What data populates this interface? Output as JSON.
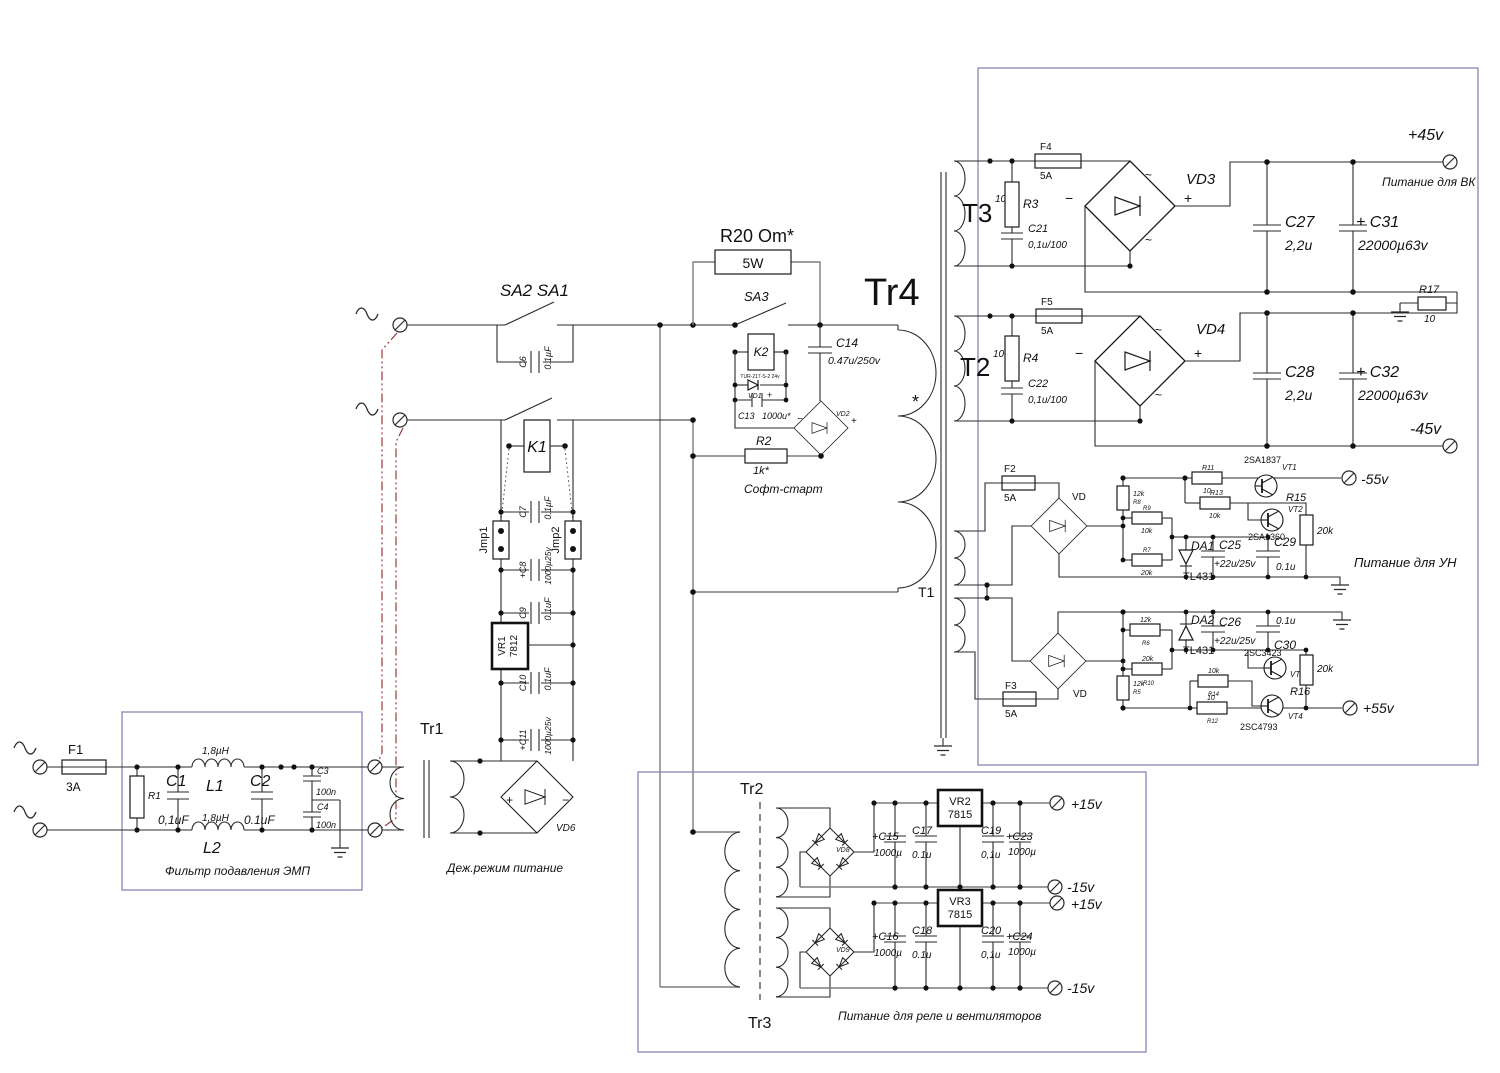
{
  "colors": {
    "line": "#2a2a2a",
    "gray_wire": "#7d7d7d",
    "box_border": "#8585b5",
    "mains_link_red": "#9b3a3a"
  },
  "sym": {
    "plus": "+",
    "minus": "−",
    "tilde": "~",
    "star": "*"
  },
  "mains": {
    "sw": "SA2 SA1"
  },
  "filter": {
    "f1": "F1",
    "f1_a": "3A",
    "r1": "R1",
    "c1": "C1",
    "c1_v": "0,1uF",
    "l1": "L1",
    "l1_v": "1,8µH",
    "l2": "L2",
    "l2_v": "1,8µH",
    "c2": "C2",
    "c2_v": "0.1uF",
    "c3": "C3",
    "c3_v": "100n",
    "c4": "C4",
    "c4_v": "100n",
    "caption": "Фильтр подавления ЭМП"
  },
  "standby": {
    "c6": "C6",
    "c6_v": "0.1µF",
    "k1": "K1",
    "c7": "C7",
    "c7_v": "0.1µF",
    "jmp1": "Jmp1",
    "jmp2": "Jmp2",
    "c8": "+C8",
    "c8_v": "1000µ25v",
    "c9": "C9",
    "c9_v": "0.1uF",
    "vr1": "VR1",
    "vr1_v": "7812",
    "c10": "C10",
    "c10_v": "0.1uF",
    "c11": "+C11",
    "c11_v": "1000µ25v",
    "tr1": "Tr1",
    "vd6": "VD6",
    "caption": "Деж.режим питание"
  },
  "soft": {
    "r20": "R20 Om*",
    "r20_w": "5W",
    "sa3": "SA3",
    "k2": "K2",
    "k2_sub": "TUR-217-S-2 24v",
    "vd1": "VD1",
    "c13": "C13",
    "c13_v": "1000u*",
    "c14": "C14",
    "c14_v": "0.47u/250v",
    "vd2": "VD2",
    "r2": "R2",
    "r2_v": "1k*",
    "caption": "Софт-старт"
  },
  "tr4": {
    "label": "Tr4",
    "t1": "T1"
  },
  "r45": {
    "t3": "T3",
    "t3_n": "10",
    "r3": "R3",
    "f4": "F4",
    "f4_a": "5A",
    "c21": "C21",
    "c21_v": "0,1u/100",
    "vd3": "VD3",
    "c27": "C27",
    "c27_v": "2,2u",
    "c31": "+ C31",
    "c31_v": "22000µ63v",
    "p45": "+45v",
    "cap_vk": "Питание для ВК",
    "r17": "R17",
    "r17_v": "10",
    "t2": "T2",
    "t2_n": "10",
    "r4": "R4",
    "f5": "F5",
    "f5_a": "5A",
    "c22": "C22",
    "c22_v": "0,1u/100",
    "vd4": "VD4",
    "c28": "C28",
    "c28_v": "2,2u",
    "c32": "+ C32",
    "c32_v": "22000µ63v",
    "n45": "-45v"
  },
  "r55": {
    "f2": "F2",
    "f2_a": "5A",
    "vd_a": "VD",
    "f3": "F3",
    "f3_a": "5A",
    "r8": "R8",
    "r8_v": "12k",
    "r9": "R9",
    "r9_v": "10k",
    "r7": "R7",
    "r7_v": "20k",
    "r11": "R11",
    "r11_v": "10",
    "r13": "R13",
    "r13_v": "10k",
    "vt1": "VT1",
    "vt1_t": "2SA1837",
    "vt2": "VT2",
    "vt2_t": "2SA1360",
    "r15": "R15",
    "r15_v": "20k",
    "da1": "DA1",
    "da1_t": "TL431",
    "c25": "C25",
    "c25_v": "+22u/25v",
    "c29": "C29",
    "c29_v": "0.1u",
    "n55": "-55v",
    "cap_un": "Питание для УН",
    "vd_b": "VD",
    "da2": "DA2",
    "da2_t": "TL431",
    "c26": "C26",
    "c26_v": "+22u/25v",
    "c30": "C30",
    "c30_v": "0.1u",
    "r6": "R6",
    "r6_v": "12k",
    "r10": "R10",
    "r10_v": "20k",
    "r5": "R5",
    "r5_v": "12k",
    "r14": "R14",
    "r14_v": "10k",
    "r12": "R12",
    "r12_v": "10",
    "vt3": "VT3",
    "vt3_t": "2SC3423",
    "vt4": "VT4",
    "vt4_t": "2SC4793",
    "r16": "R16",
    "r16_v": "20k",
    "p55": "+55v"
  },
  "aux": {
    "tr2": "Tr2",
    "tr3": "Tr3",
    "vd8": "VD8",
    "vd9": "VD9",
    "c15": "+C15",
    "c15_v": "1000µ",
    "c17": "C17",
    "c17_v": "0.1u",
    "vr2": "VR2",
    "vr2_v": "7815",
    "c19": "C19",
    "c19_v": "0,1u",
    "c23": "+C23",
    "c23_v": "1000µ",
    "p15a": "+15v",
    "n15a": "-15v",
    "p15b": "+15v",
    "n15b": "-15v",
    "c16": "+C16",
    "c16_v": "1000µ",
    "c18": "C18",
    "c18_v": "0.1u",
    "vr3": "VR3",
    "vr3_v": "7815",
    "c20": "C20",
    "c20_v": "0,1u",
    "c24": "+C24",
    "c24_v": "1000µ",
    "caption": "Питание для реле и вентиляторов"
  }
}
